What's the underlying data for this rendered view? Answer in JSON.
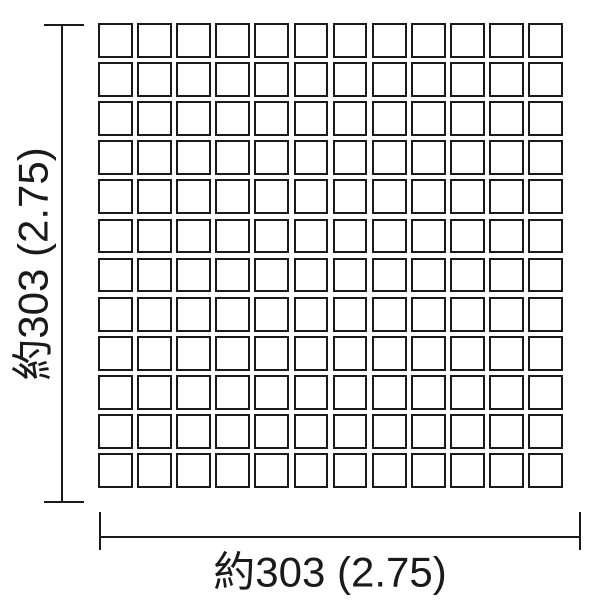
{
  "diagram": {
    "type": "tile-sheet-dimension-diagram",
    "background_color": "#ffffff",
    "ink_color": "#1a1a1a",
    "grid": {
      "rows": 12,
      "columns": 12
    },
    "dimensions": {
      "width_label": "約303 (2.75)",
      "height_label": "約303 (2.75)"
    }
  }
}
